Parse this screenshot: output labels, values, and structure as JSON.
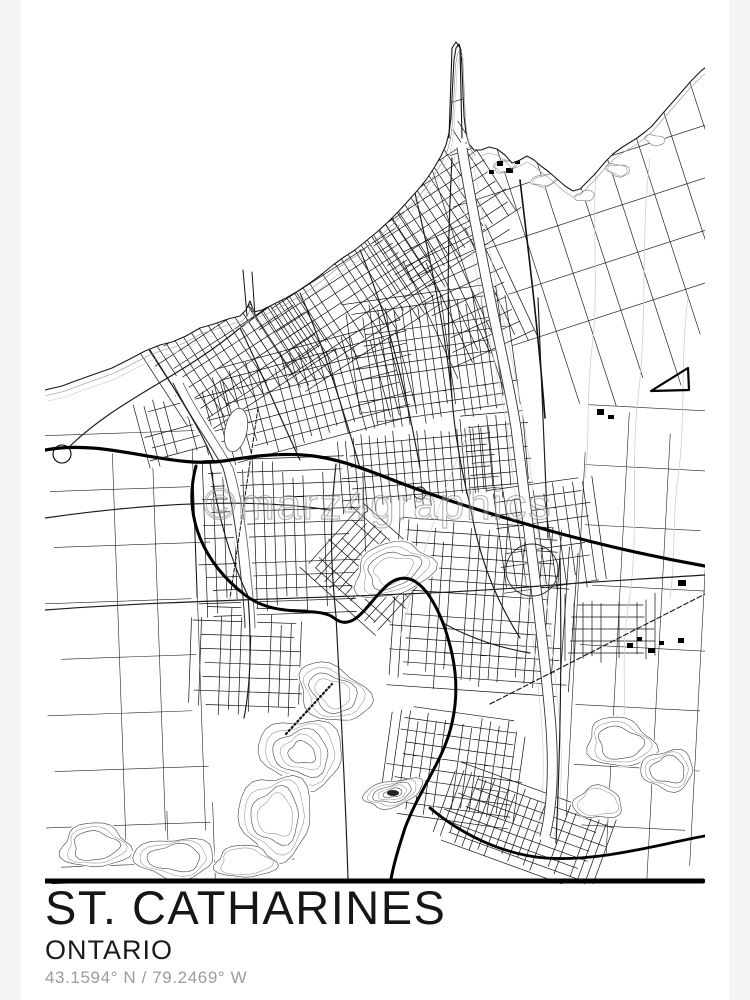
{
  "poster": {
    "title": "ST. CATHARINES",
    "subtitle": "ONTARIO",
    "coordinates": "43.1594° N / 79.2469° W",
    "watermark": "©marz4graphics",
    "colors": {
      "page_background": "#f5f5f6",
      "paper": "#ffffff",
      "map_line": "#111111",
      "contour_gray": "#c9c9c9",
      "muted_text": "#9b9b9b"
    }
  }
}
